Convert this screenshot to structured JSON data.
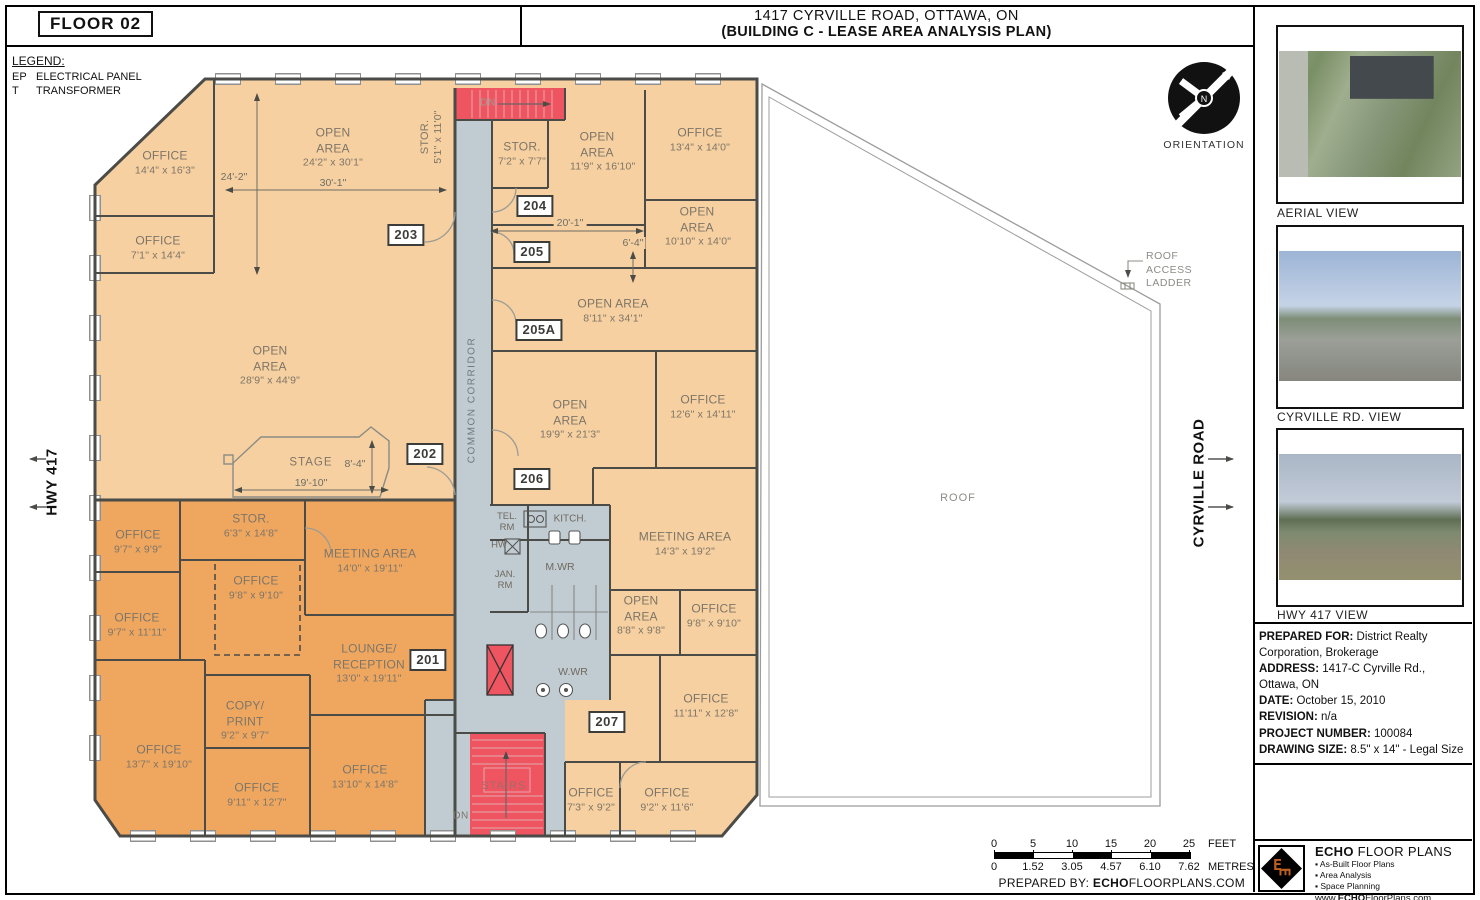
{
  "header": {
    "floor_label": "FLOOR 02",
    "title_line1": "1417 CYRVILLE ROAD, OTTAWA, ON",
    "title_line2": "(BUILDING C - LEASE AREA ANALYSIS PLAN)"
  },
  "legend": {
    "title": "LEGEND:",
    "items": [
      {
        "abbr": "EP",
        "label": "ELECTRICAL PANEL"
      },
      {
        "abbr": "T",
        "label": "TRANSFORMER"
      }
    ]
  },
  "orientation": {
    "label": "ORIENTATION",
    "north": "N"
  },
  "site": {
    "hwy": "HWY 417",
    "road": "CYRVILLE ROAD",
    "roof": "ROOF",
    "roof_access": "ROOF ACCESS LADDER"
  },
  "plan": {
    "corridor": "COMMON CORRIDOR",
    "stage": "STAGE",
    "stairs": "STAIRS",
    "down": "DN",
    "rooms": [
      {
        "name": "OFFICE",
        "dims": "14'4\" x 16'3\""
      },
      {
        "name": "OFFICE",
        "dims": "7'1\" x 14'4\""
      },
      {
        "name": "OPEN AREA",
        "dims": "24'2\" x 30'1\""
      },
      {
        "name": "STOR.",
        "dims": "5'1\" x 11'0\""
      },
      {
        "name": "OPEN AREA",
        "dims": "28'9\" x 44'9\""
      },
      {
        "name": "STOR.",
        "dims": "7'2\" x 7'7\""
      },
      {
        "name": "OPEN AREA",
        "dims": "11'9\" x 16'10\""
      },
      {
        "name": "OFFICE",
        "dims": "13'4\" x 14'0\""
      },
      {
        "name": "OPEN AREA",
        "dims": "10'10\" x 14'0\""
      },
      {
        "name": "OPEN AREA",
        "dims": "8'11\" x 34'1\""
      },
      {
        "name": "OPEN AREA",
        "dims": "19'9\" x 21'3\""
      },
      {
        "name": "OFFICE",
        "dims": "12'6\" x 14'11\""
      },
      {
        "name": "MEETING AREA",
        "dims": "14'3\" x 19'2\""
      },
      {
        "name": "OPEN AREA",
        "dims": "8'8\" x 9'8\""
      },
      {
        "name": "OFFICE",
        "dims": "9'8\" x 9'10\""
      },
      {
        "name": "OFFICE",
        "dims": "11'11\" x 12'8\""
      },
      {
        "name": "OFFICE",
        "dims": "7'3\" x 9'2\""
      },
      {
        "name": "OFFICE",
        "dims": "9'2\" x 11'6\""
      },
      {
        "name": "OFFICE",
        "dims": "9'7\" x 9'9\""
      },
      {
        "name": "STOR.",
        "dims": "6'3\" x 14'8\""
      },
      {
        "name": "OFFICE",
        "dims": "9'8\" x 9'10\""
      },
      {
        "name": "MEETING AREA",
        "dims": "14'0\" x 19'11\""
      },
      {
        "name": "OFFICE",
        "dims": "9'7\" x 11'11\""
      },
      {
        "name": "LOUNGE/ RECEPTION",
        "dims": "13'0\" x 19'11\""
      },
      {
        "name": "COPY/ PRINT",
        "dims": "9'2\" x 9'7\""
      },
      {
        "name": "OFFICE",
        "dims": "13'7\" x 19'10\""
      },
      {
        "name": "OFFICE",
        "dims": "9'11\" x 12'7\""
      },
      {
        "name": "OFFICE",
        "dims": "13'10\" x 14'8\""
      }
    ],
    "service": {
      "tel": "TEL. RM",
      "kitch": "KITCH.",
      "hw": "HW",
      "jan": "JAN. RM",
      "mwr": "M.WR",
      "wwr": "W.WR"
    },
    "badges": [
      "201",
      "202",
      "203",
      "204",
      "205",
      "205A",
      "206",
      "207"
    ],
    "dims": [
      "24'-2\"",
      "30'-1\"",
      "20'-1\"",
      "6'-4\"",
      "8'-4\"",
      "19'-10\""
    ]
  },
  "sidebar": {
    "views": [
      "AERIAL VIEW",
      "CYRVILLE RD. VIEW",
      "HWY 417 VIEW"
    ],
    "info": [
      {
        "label": "PREPARED FOR:",
        "value": " District Realty Corporation, Brokerage"
      },
      {
        "label": "ADDRESS:",
        "value": " 1417-C Cyrville Rd., Ottawa, ON"
      },
      {
        "label": "DATE:",
        "value": " October 15, 2010"
      },
      {
        "label": "REVISION:",
        "value": " n/a"
      },
      {
        "label": "PROJECT NUMBER:",
        "value": " 100084"
      },
      {
        "label": "DRAWING SIZE:",
        "value": " 8.5\" x 14\" - Legal Size"
      }
    ],
    "logo": {
      "brand_bold": "ECHO",
      "brand_rest": " FLOOR PLANS",
      "services": [
        "As-Built Floor Plans",
        "Area Analysis",
        "Space Planning"
      ],
      "website_prefix": "www.",
      "website_bold": "ECHO",
      "website_rest": "FloorPlans.com"
    }
  },
  "scalebar": {
    "feet": [
      "0",
      "5",
      "10",
      "15",
      "20",
      "25"
    ],
    "feet_unit": "FEET",
    "metres": [
      "0",
      "1.52",
      "3.05",
      "4.57",
      "6.10",
      "7.62"
    ],
    "metres_unit": "METRES",
    "prepared_by": "PREPARED BY: ",
    "site_bold": "ECHO",
    "site_rest": "FLOORPLANS.COM"
  },
  "colors": {
    "room_light": "#F6D0A0",
    "room_dark": "#EFA760",
    "circulation": "#C0CCD2",
    "stairs_red": "#EF5560",
    "wall": "#4B4B47",
    "label_text": "#7D7568"
  }
}
